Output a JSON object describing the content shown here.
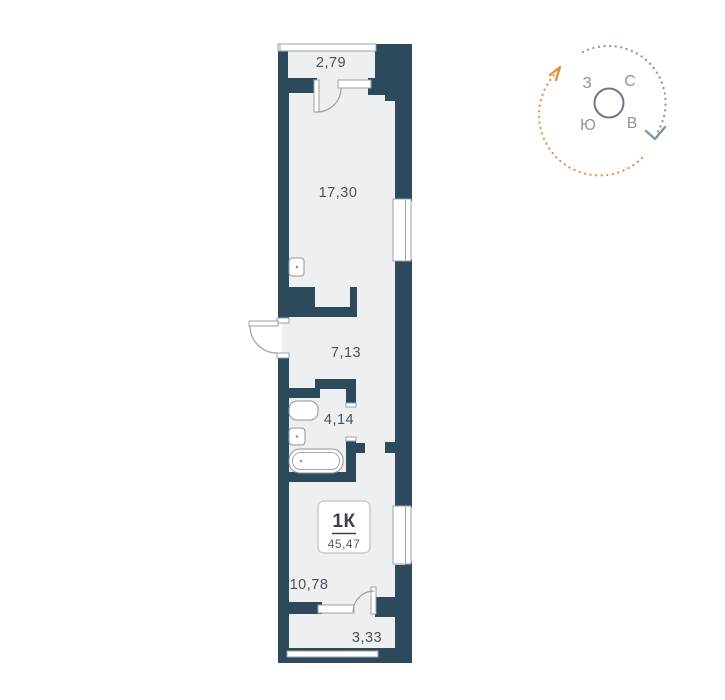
{
  "floorplan": {
    "apartment_type": "1К",
    "total_area": "45,47",
    "rooms": [
      {
        "name": "balcony-top",
        "area": "2,79"
      },
      {
        "name": "living-room",
        "area": "17,30"
      },
      {
        "name": "hallway",
        "area": "7,13"
      },
      {
        "name": "bathroom",
        "area": "4,14"
      },
      {
        "name": "kitchen",
        "area": "10,78"
      },
      {
        "name": "balcony-bottom",
        "area": "3,33"
      }
    ],
    "colors": {
      "wall": "#2d4a5c",
      "floor_fill": "#edeff0",
      "fixture_outline": "#9aa0a6",
      "label_text": "#46525c"
    }
  },
  "compass": {
    "letters": {
      "west": "З",
      "north": "С",
      "south": "Ю",
      "east": "В"
    },
    "colors": {
      "arc_orange": "#e5913c",
      "arc_blue": "#7f96a8",
      "ring": "#70777f",
      "letter_text": "#8c9299"
    }
  }
}
